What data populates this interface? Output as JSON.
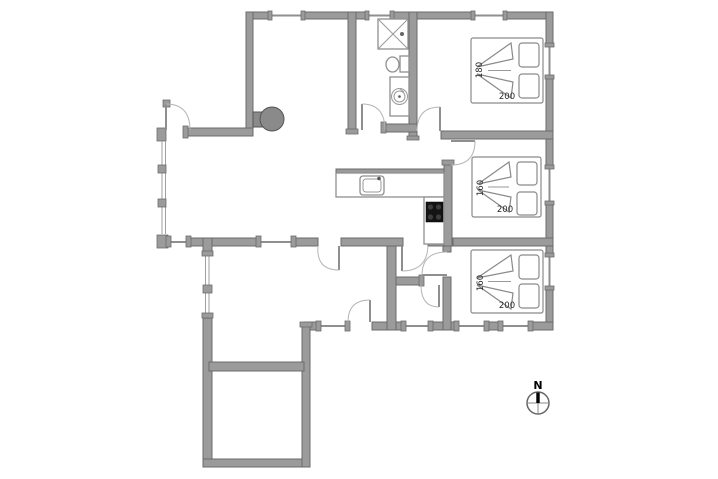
{
  "plan": {
    "type": "house-floor-plan",
    "background": "#ffffff"
  },
  "colors": {
    "wall_fill": "#9b9b9b",
    "wall_stroke": "#6b6b6b",
    "fixture_stroke": "#8f8f8f",
    "wood_stove_fill": "#8a8a8a",
    "cooktop_fill": "#141414",
    "label_text": "#2b2b2b"
  },
  "bedrooms": [
    {
      "name": "bedroom-top-right",
      "bed_width_label": "180",
      "bed_length_label": "200"
    },
    {
      "name": "bedroom-middle-right",
      "bed_width_label": "160",
      "bed_length_label": "200"
    },
    {
      "name": "bedroom-bottom-right",
      "bed_width_label": "160",
      "bed_length_label": "200"
    }
  ],
  "fixtures": [
    "shower-cabin",
    "toilet",
    "washbasin",
    "wood-stove",
    "kitchen-sink",
    "cooktop",
    "kitchen-counter"
  ],
  "compass": {
    "north_label": "N"
  }
}
